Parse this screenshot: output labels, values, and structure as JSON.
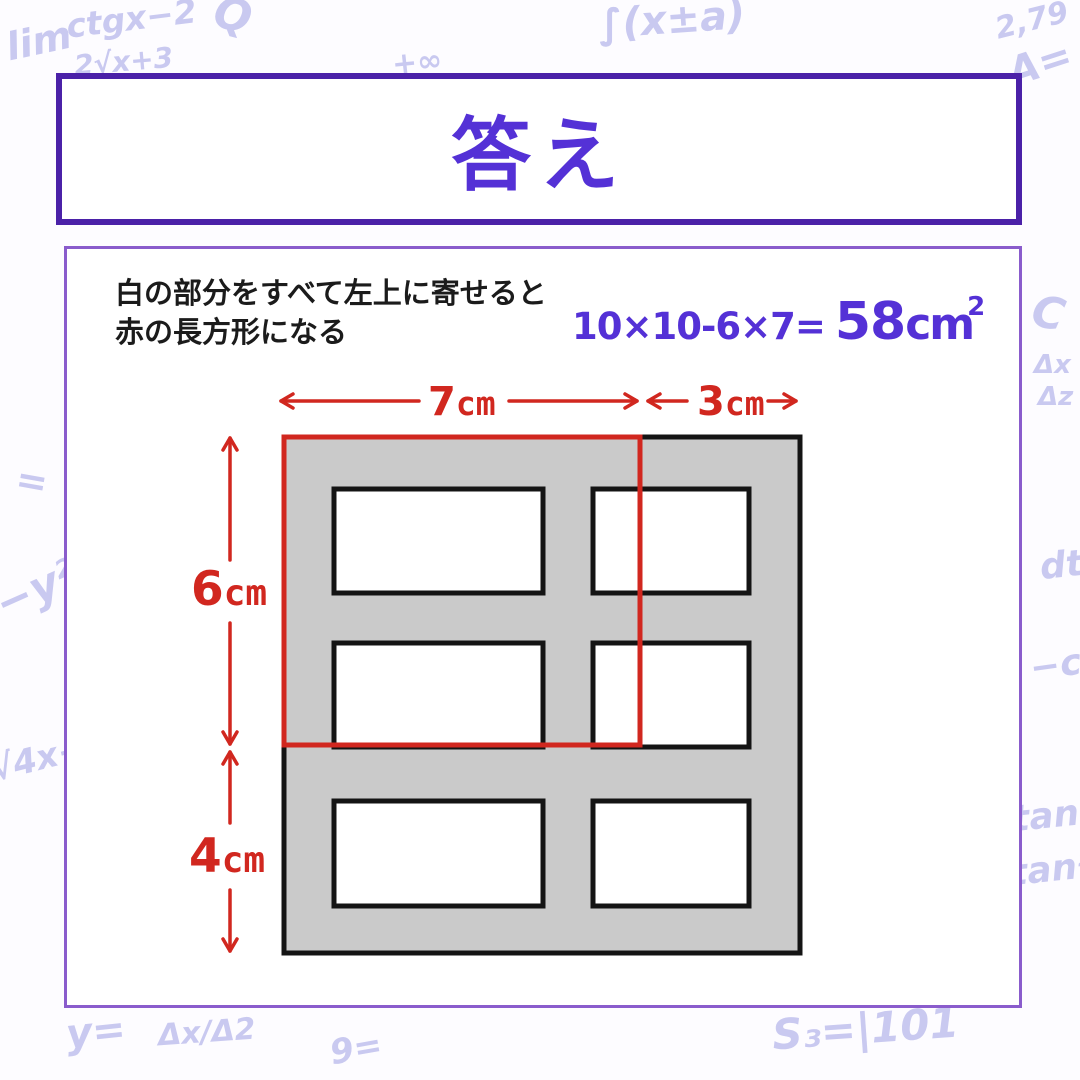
{
  "colors": {
    "accent_purple": "#5431d6",
    "header_border": "#4b21a8",
    "panel_border": "#8a5ccc",
    "highlight_red": "#d1271f",
    "shaded_gray": "#cacaca",
    "outline_black": "#141414",
    "scribble_lavender": "#c9c9f0",
    "text_black": "#1b1b1b"
  },
  "header": {
    "title": "答え"
  },
  "panel": {
    "explanation_line1": "白の部分をすべて左上に寄せると",
    "explanation_line2": "赤の長方形になる",
    "formula": {
      "expression": "10×10-6×7=",
      "result_value": "58",
      "result_unit": "cm",
      "result_exponent": "2"
    }
  },
  "diagram": {
    "dimensions": {
      "top_width_red": {
        "value": "7",
        "unit": "cm"
      },
      "top_width_gray": {
        "value": "3",
        "unit": "cm"
      },
      "side_height_red": {
        "value": "6",
        "unit": "cm"
      },
      "side_height_gray": {
        "value": "4",
        "unit": "cm"
      }
    }
  },
  "background_scribbles": [
    {
      "text": "lim",
      "x": 6,
      "y": 22,
      "size": 38,
      "rot": -12
    },
    {
      "text": "ctgx−2",
      "x": 66,
      "y": 2,
      "size": 33,
      "rot": -7
    },
    {
      "text": "2√x+3",
      "x": 74,
      "y": 48,
      "size": 28,
      "rot": -5
    },
    {
      "text": "Q",
      "x": 214,
      "y": -6,
      "size": 44,
      "rot": 14
    },
    {
      "text": "+∞",
      "x": 392,
      "y": 48,
      "size": 30,
      "rot": -6
    },
    {
      "text": "∫(x±a)",
      "x": 598,
      "y": 0,
      "size": 40,
      "rot": -4
    },
    {
      "text": "2,79",
      "x": 995,
      "y": 6,
      "size": 30,
      "rot": -14
    },
    {
      "text": "A=",
      "x": 1008,
      "y": 44,
      "size": 40,
      "rot": -18
    },
    {
      "text": "C",
      "x": 1032,
      "y": 292,
      "size": 44,
      "rot": 12
    },
    {
      "text": "Δx",
      "x": 1034,
      "y": 352,
      "size": 26,
      "rot": 0
    },
    {
      "text": "Δz",
      "x": 1038,
      "y": 384,
      "size": 26,
      "rot": 0
    },
    {
      "text": "dt",
      "x": 1040,
      "y": 548,
      "size": 36,
      "rot": -6
    },
    {
      "text": "−c",
      "x": 1030,
      "y": 648,
      "size": 36,
      "rot": -8
    },
    {
      "text": "tan(",
      "x": 1012,
      "y": 798,
      "size": 36,
      "rot": -6
    },
    {
      "text": "tan²",
      "x": 1010,
      "y": 852,
      "size": 36,
      "rot": -6
    },
    {
      "text": "=",
      "x": 16,
      "y": 462,
      "size": 38,
      "rot": 10
    },
    {
      "text": "−y²",
      "x": -6,
      "y": 568,
      "size": 44,
      "rot": -24
    },
    {
      "text": "√4x+",
      "x": -10,
      "y": 742,
      "size": 34,
      "rot": -14
    },
    {
      "text": "y=",
      "x": 66,
      "y": 1012,
      "size": 40,
      "rot": -6
    },
    {
      "text": "Δx/Δ2",
      "x": 158,
      "y": 1018,
      "size": 30,
      "rot": -4
    },
    {
      "text": "9=",
      "x": 330,
      "y": 1032,
      "size": 34,
      "rot": -10
    },
    {
      "text": "S₃=|101",
      "x": 772,
      "y": 1008,
      "size": 42,
      "rot": -4
    }
  ]
}
